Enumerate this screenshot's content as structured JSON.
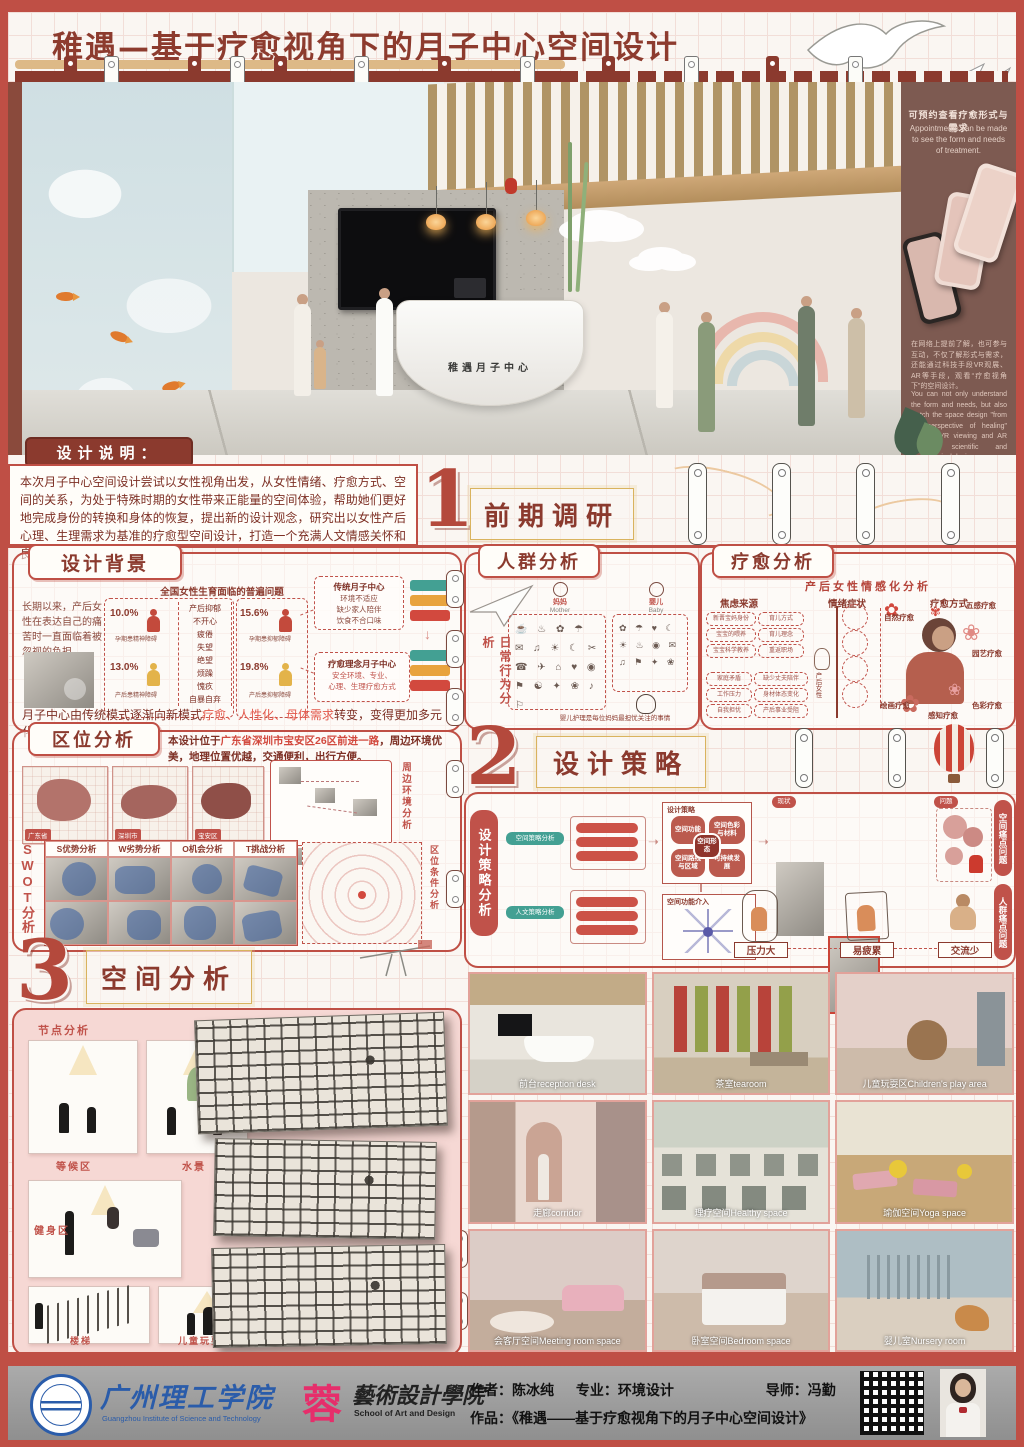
{
  "title": "稚遇—基于疗愈视角下的月子中心空间设计",
  "render": {
    "desk_sign": "稚遇月子中心",
    "sidebar": {
      "headline_zh": "可预约查看疗愈形式与需求",
      "headline_en": "Appointments can be made to see the form and needs of treatment.",
      "body_zh": "在网络上提前了解，也可参与互动，不仅了解形式与需求，还能通过科技手段VR观展、AR等手段，观看“疗愈视角下”的空间设计。",
      "body_en": "You can not only understand the form and needs, but also watch the space design \"from the perspective of healing\" through VR viewing and AR through scientific and technological design."
    }
  },
  "description": {
    "label": "设计说明：",
    "text": "本次月子中心空间设计尝试以女性视角出发，从女性情绪、疗愈方式、空间的关系，为处于特殊时期的女性带来正能量的空间体验，帮助她们更好地完成身份的转换和身体的恢复，提出新的设计观念，研究出以女性产后心理、生理需求为基准的疗愈型空间设计，打造一个充满人文情感关怀和良好感官体验的生活空间。"
  },
  "sections": {
    "one": {
      "num": "1",
      "title": "前期调研"
    },
    "two": {
      "num": "2",
      "title": "设计策略"
    },
    "three": {
      "num": "3",
      "title": "空间分析"
    }
  },
  "background": {
    "title": "设计背景",
    "intro": "长期以来，产后女性在表达自己的痛苦时一直面临着被忽视的负担。",
    "chart_title": "全国女性生育面临的普遍问题",
    "stats": [
      {
        "pct": "10.0%",
        "label": "孕期患精神障碍"
      },
      {
        "pct": "15.6%",
        "label": "孕期患抑郁障碍"
      },
      {
        "pct": "13.0%",
        "label": "产后患精神障碍"
      },
      {
        "pct": "19.8%",
        "label": "产后患抑郁障碍"
      }
    ],
    "symptoms": [
      "产后抑郁",
      "不开心",
      "疲倦",
      "失望",
      "绝望",
      "烦躁",
      "愧疚",
      "自暴自弃"
    ],
    "traditional": {
      "title": "传统月子中心",
      "l1": "环境不适应",
      "l2": "缺少家人陪伴",
      "l3": "饮食不合口味"
    },
    "healing": {
      "title": "疗愈理念月子中心",
      "l1": "安全环境、专业、",
      "l2": "心理、生理疗愈方式"
    },
    "conclusion": {
      "pre": "月子中心由传统模式逐渐向新模式",
      "highlight": "疗愈、人性化、母体需求",
      "post": "转变，变得更加多元化。"
    }
  },
  "location": {
    "title": "区位分析",
    "desc_pre": "本设计位于",
    "desc_red": "广东省深圳市宝安区26区前进一路",
    "desc_post": "，周边环境优美，地理位置优越，交通便利，出行方便。",
    "maps": [
      "广东省",
      "深圳市",
      "宝安区"
    ],
    "swot_label": "SWOT分析",
    "swot_headers": [
      "S优势分析",
      "W劣势分析",
      "O机会分析",
      "T挑战分析"
    ],
    "env_label": "周边环境分析",
    "radial_label": "区位条件分析"
  },
  "crowd": {
    "title": "人群分析",
    "side_label": "日常行为分析",
    "mother_zh": "妈妈",
    "mother_en": "Mother",
    "baby_zh": "婴儿",
    "baby_en": "Baby",
    "mother_icons": "☕ ♨ ✿ ☂ ✉ ♫ ☀ ☾ ✂ ☎ ✈ ⌂ ♥ ◉ ⚑ ☯ ✦ ❀ ♪ ⚐",
    "baby_icons": "✿ ☂ ♥ ☾ ☀ ♨ ◉ ✉ ♫ ⚑ ✦ ❀",
    "caption": "婴儿护理是每位妈妈最担忧关注的事情"
  },
  "healing": {
    "title": "疗愈分析",
    "subtitle": "产后女性情感化分析",
    "col_source": "焦虑来源",
    "col_symptom": "情绪症状",
    "col_method": "疗愈方式",
    "center_label": "产后女性",
    "sources": [
      "新晋宝妈身份",
      "宝宝的喂养",
      "宝宝科学教养",
      "育儿方式",
      "育儿理念",
      "重返职场",
      "家庭矛盾",
      "工作压力",
      "自我担忧",
      "缺少丈夫陪伴",
      "身材体态变化",
      "产后事业受阻"
    ],
    "methods": [
      "自然疗愈",
      "五感疗愈",
      "园艺疗愈",
      "绘画疗愈",
      "感知疗愈",
      "色彩疗愈"
    ],
    "flowers": [
      "✿",
      "❀",
      "✿",
      "❀",
      "✾"
    ]
  },
  "strategy": {
    "side_label": "设计策略分析",
    "flow_title": "设计策略",
    "petals": [
      "空间功能",
      "空间色彩与材料",
      "空间路线与区域",
      "可持续发展"
    ],
    "petal_center": "空间形态",
    "radial_title": "空间功能介入",
    "group1_label": "空间策略分析",
    "group2_label": "人文策略分析",
    "tag_current": "现状",
    "tag_problem": "问题",
    "right_tab1": "空间痛点问题",
    "right_tab2": "人群痛点问题",
    "pains": [
      "压力大",
      "易疲累",
      "交流少"
    ]
  },
  "space": {
    "node_label": "节点分析",
    "nodes": [
      "等候区",
      "水景",
      "健身区",
      "楼梯",
      "儿童玩耍区"
    ]
  },
  "renders": {
    "items": [
      {
        "label": "前台reception desk"
      },
      {
        "label": "茶室tearoom"
      },
      {
        "label": "儿童玩耍区Children's play area"
      },
      {
        "label": "走廊corridor"
      },
      {
        "label": "理疗空间Healthy space"
      },
      {
        "label": "瑜伽空间Yoga space"
      },
      {
        "label": "会客厅空间Meeting room space"
      },
      {
        "label": "卧室空间Bedroom space"
      },
      {
        "label": "婴儿室Nursery room"
      }
    ]
  },
  "footer": {
    "school_zh": "广州理工学院",
    "school_en": "Guangzhou Institute of Science and Technology",
    "college_logo": "蓉",
    "college_zh": "藝術設計學院",
    "college_en": "School of Art and Design",
    "author": "作者：陈冰纯",
    "major": "专业：环境设计",
    "advisor": "导师：冯勤",
    "work": "作品：《稚遇——基于疗愈视角下的月子中心空间设计》"
  }
}
